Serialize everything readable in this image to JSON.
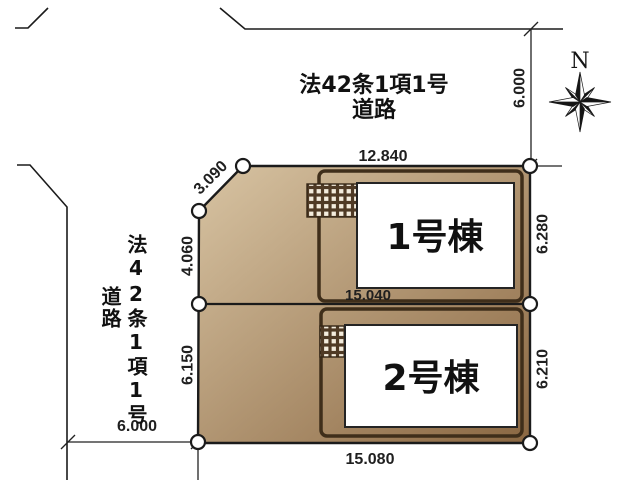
{
  "roads": {
    "top": {
      "line1": "法42条1項1号",
      "line2": "道路"
    },
    "left": {
      "line1": "法42条1項1号",
      "line2": "道路"
    }
  },
  "compass": {
    "north": "N"
  },
  "buildings": {
    "b1": {
      "label": "1号棟"
    },
    "b2": {
      "label": "2号棟"
    }
  },
  "dimensions": {
    "top_frontage": "12.840",
    "top_road_width": "6.000",
    "lot1_depth_right": "6.280",
    "lot2_depth_right": "6.210",
    "lot1_width_bottom": "15.040",
    "lot2_width_bottom": "15.080",
    "left_upper": "4.060",
    "left_lower": "6.150",
    "corner_cut": "3.090",
    "left_road_width": "6.000"
  },
  "colors": {
    "parcel_light": "#d8c4a3",
    "parcel_dark": "#8a6742",
    "lot_border": "#3f2e1a",
    "hatch_bg": "#4f3a25",
    "hatch_square": "#f3ecdd",
    "building_fill": "#ffffff",
    "line": "#1b1b1b"
  }
}
